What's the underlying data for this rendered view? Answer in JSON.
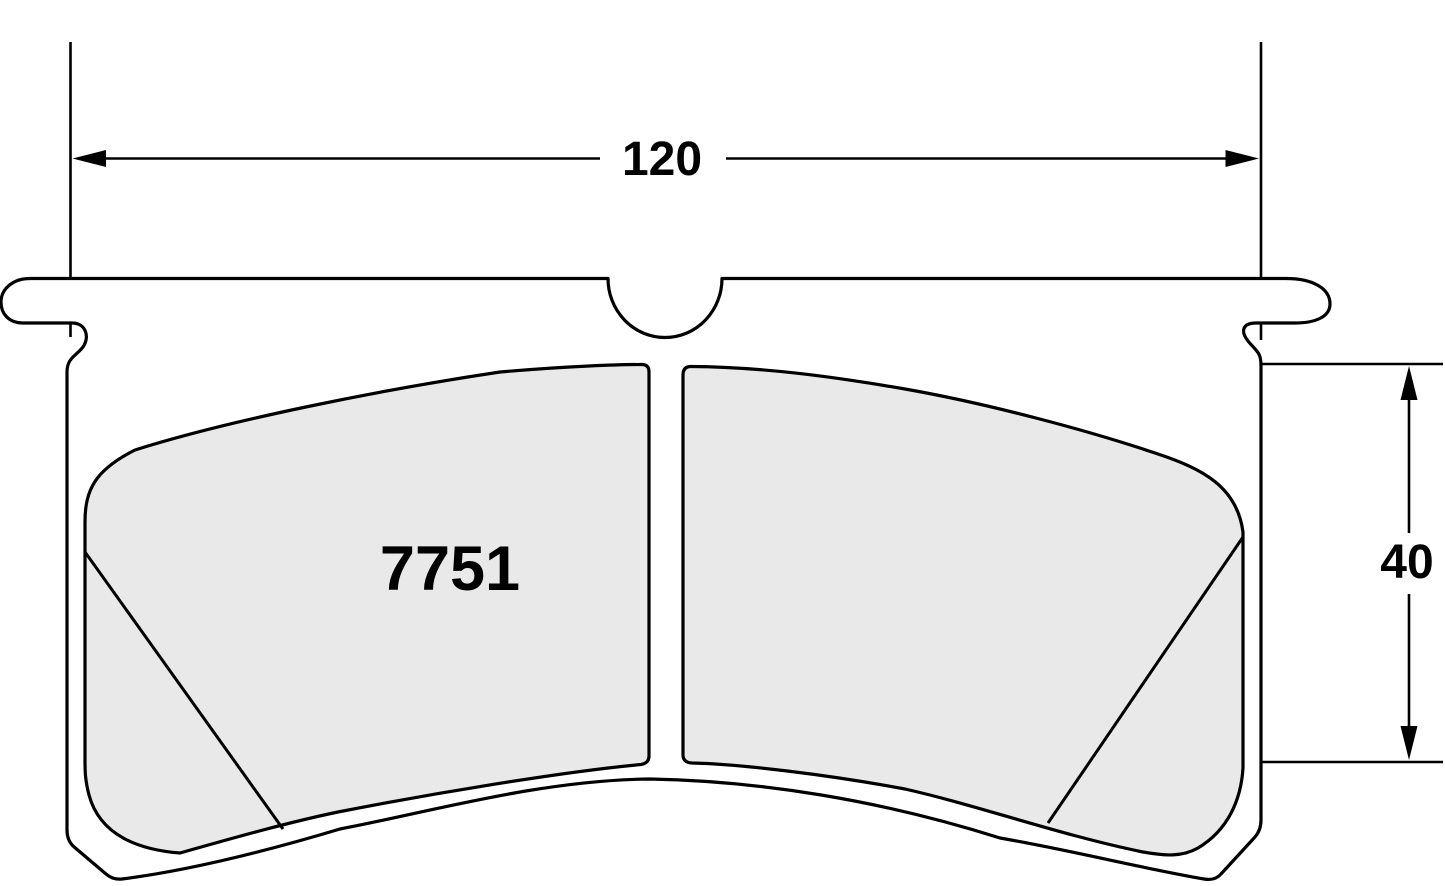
{
  "drawing": {
    "title": "Brake pad outline drawing",
    "part_number": "7751",
    "width_dimension": {
      "value": "120",
      "orientation": "horizontal",
      "arrows": [
        "left-arrowhead",
        "right-arrowhead"
      ]
    },
    "height_dimension": {
      "value": "40",
      "orientation": "vertical",
      "arrows": [
        "up-arrowhead",
        "down-arrowhead"
      ]
    }
  },
  "colors": {
    "line": "#000000",
    "pad_fill": "#e9e9e9",
    "plate_fill": "#ffffff",
    "background": "#ffffff"
  }
}
